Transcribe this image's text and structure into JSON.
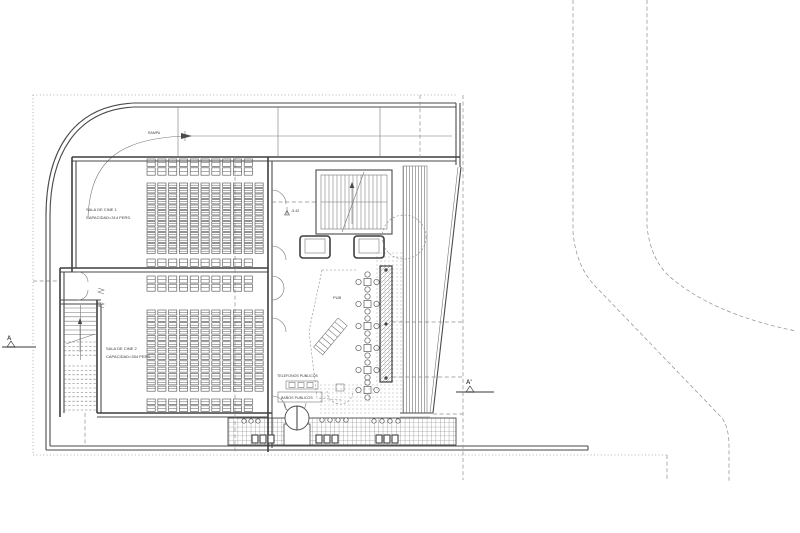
{
  "plan": {
    "hall1": {
      "name": "SALA DE CINE 1",
      "capacity": "CAPACIDAD=314 PERS."
    },
    "hall2": {
      "name": "SALA DE CINE 2",
      "capacity": "CAPACIDAD=354 PERS."
    },
    "pub_label": "PUB",
    "phones_label": "TELEFONOS PUBLICOS",
    "restrooms_label": "BAÑOS PUBLICOS",
    "ramp_label": "RAMPA",
    "level_marker": "-5.42",
    "section_left": "A",
    "section_right": "A'",
    "colors": {
      "wall": "#4a4a4a",
      "thin_line": "#767676",
      "dashed_line": "#8d8d8d",
      "stipple": "#9b9b9b",
      "background": "#ffffff"
    }
  }
}
